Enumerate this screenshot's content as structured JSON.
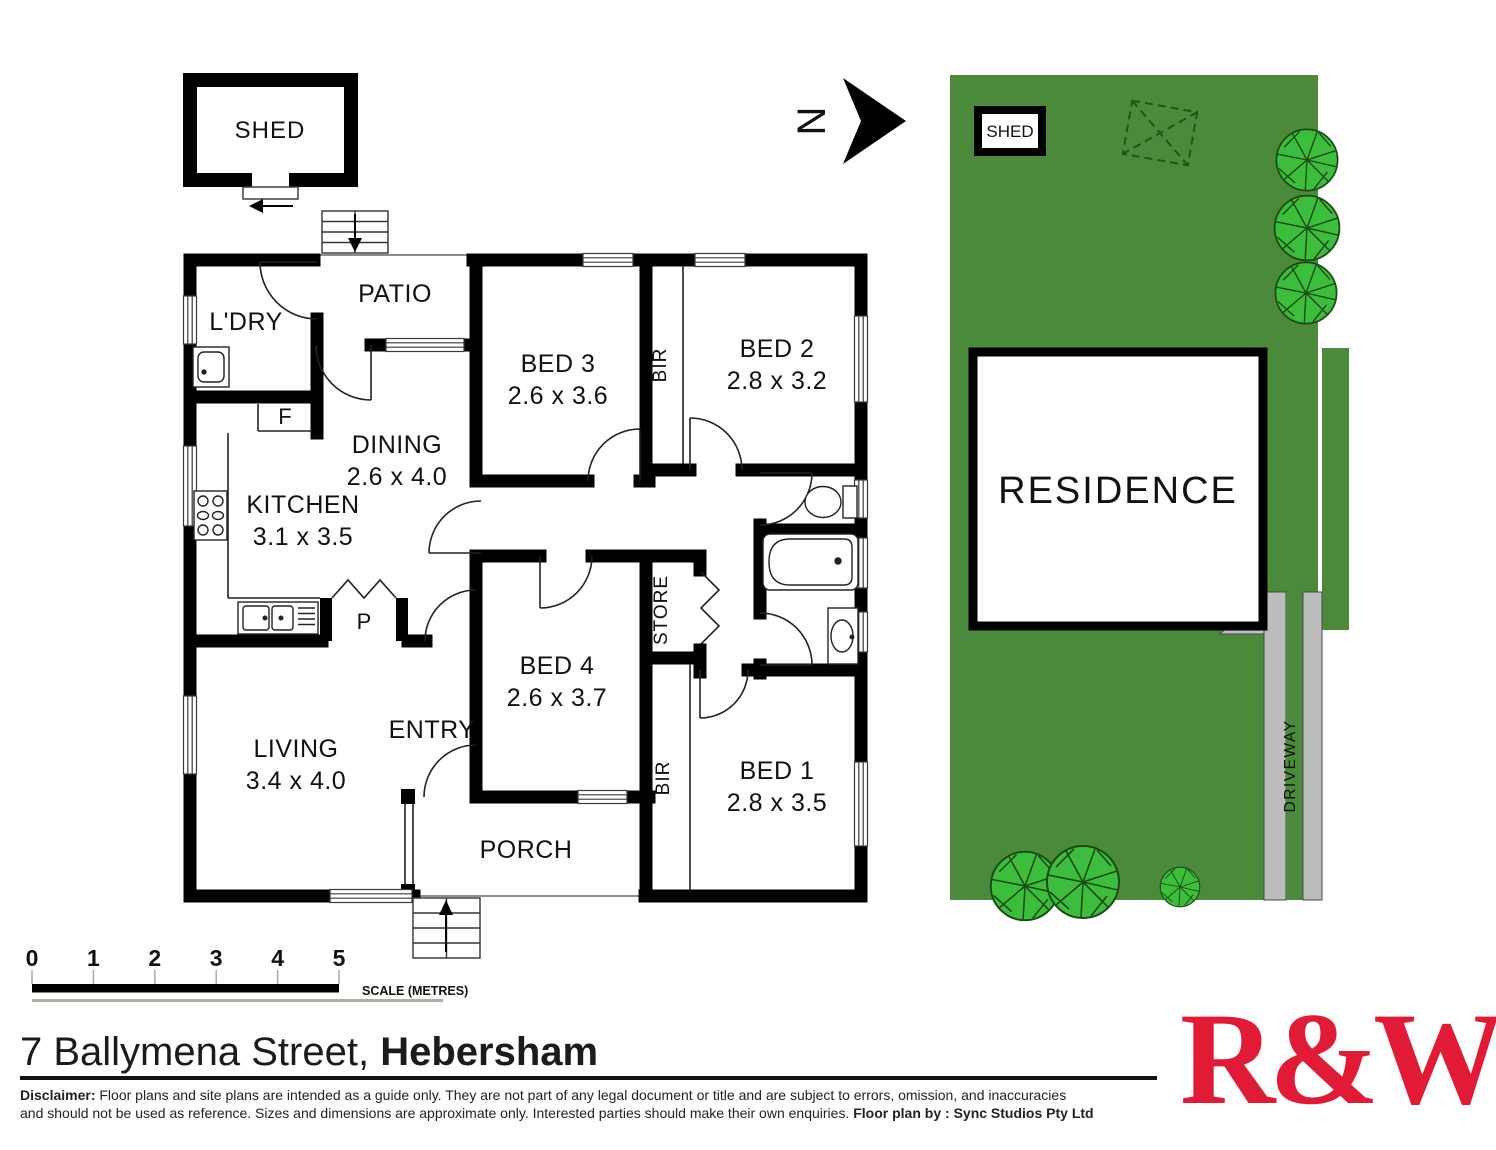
{
  "floorplan": {
    "shed": {
      "label": "SHED"
    },
    "rooms": {
      "ldry": {
        "name": "L'DRY"
      },
      "patio": {
        "name": "PATIO"
      },
      "dining": {
        "name": "DINING",
        "dims": "2.6 x 4.0"
      },
      "kitchen": {
        "name": "KITCHEN",
        "dims": "3.1 x 3.5"
      },
      "bed3": {
        "name": "BED 3",
        "dims": "2.6 x 3.6"
      },
      "bed2": {
        "name": "BED 2",
        "dims": "2.8 x 3.2"
      },
      "bed4": {
        "name": "BED 4",
        "dims": "2.6 x 3.7"
      },
      "bed1": {
        "name": "BED 1",
        "dims": "2.8 x 3.5"
      },
      "living": {
        "name": "LIVING",
        "dims": "3.4 x 4.0"
      },
      "entry": {
        "name": "ENTRY"
      },
      "porch": {
        "name": "PORCH"
      }
    },
    "closets": {
      "bir_top": "BIR",
      "bir_bottom": "BIR",
      "store": "STORE",
      "fridge": "F",
      "pantry": "P"
    }
  },
  "compass": {
    "north": "N"
  },
  "siteplan": {
    "shed": "SHED",
    "residence": "RESIDENCE",
    "driveway": "DRIVEWAY",
    "colors": {
      "lawn": "#4a8a3a",
      "tree": "#3dbd3d",
      "tree_outline": "#1c4a14",
      "paving": "#bcbcbc"
    }
  },
  "scalebar": {
    "ticks": [
      "0",
      "1",
      "2",
      "3",
      "4",
      "5"
    ],
    "caption": "SCALE (METRES)"
  },
  "footer": {
    "address_street": "7 Ballymena Street, ",
    "address_suburb": "Hebersham",
    "disclaimer_label": "Disclaimer:",
    "disclaimer_line1": " Floor plans and site plans are intended as a guide only. They are not part of any legal document or title and are subject to errors, omission, and inaccuracies",
    "disclaimer_line2": "and should not be used as reference. Sizes and dimensions are approximate only. Interested parties should make their own enquiries. ",
    "credit": "Floor plan by : Sync Studios Pty Ltd",
    "logo": "R&W",
    "logo_color": "#e11b35"
  }
}
